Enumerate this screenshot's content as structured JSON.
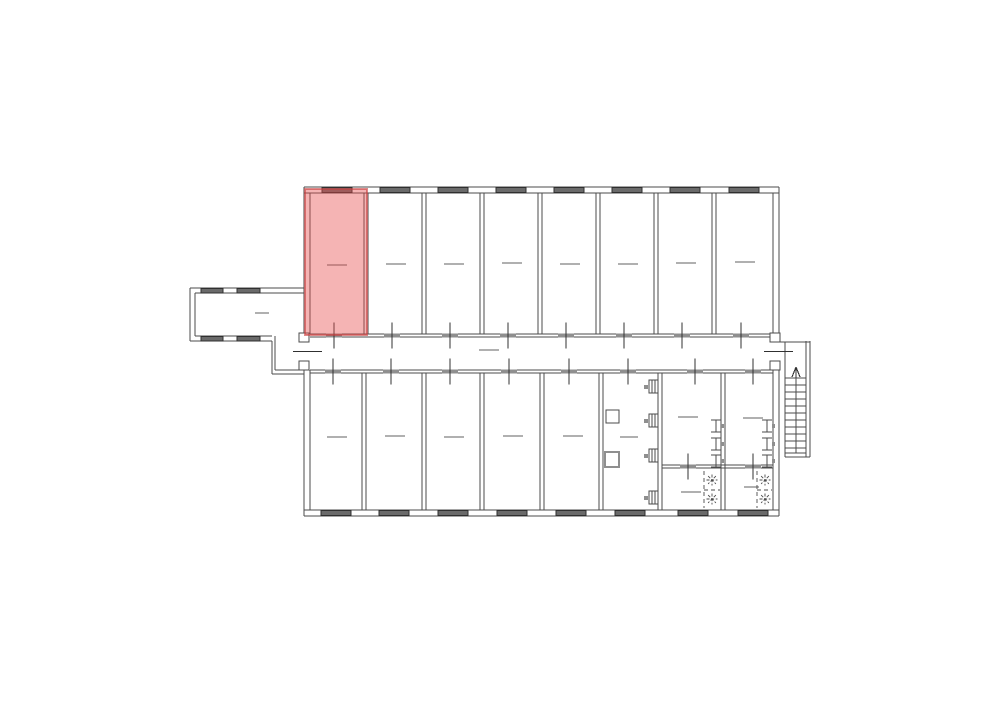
{
  "meta": {
    "type": "architectural-floor-plan",
    "highlighted_room": "top-row room 1 (leftmost)",
    "top_room_count": 8,
    "bottom_room_count": 10
  },
  "colors": {
    "background": "#ffffff",
    "wall": "#4b4b4b",
    "window_fill": "#6a6a6a",
    "window_edge": "#2f2f2f",
    "door_tick": "#8f8f8f",
    "door_line": "#303030",
    "dash": "#606060",
    "fixture": "#4b4b4b",
    "fixture_gray": "#8f8f8f",
    "highlight_fill": "#e74c4c",
    "highlight_fill_opacity": 0.42,
    "highlight_stroke": "#c83c3c",
    "highlight_stroke_opacity": 0.6
  },
  "plan": {
    "canvas": {
      "w": 1000,
      "h": 707
    },
    "highlight": {
      "x": 305,
      "y": 189,
      "w": 62,
      "h": 146
    },
    "walls": [
      [
        304,
        187,
        779,
        187
      ],
      [
        304,
        193,
        779,
        193
      ],
      [
        304,
        516,
        779,
        516
      ],
      [
        304,
        510,
        779,
        510
      ],
      [
        304,
        187,
        304,
        334
      ],
      [
        304,
        370,
        304,
        516
      ],
      [
        310,
        193,
        310,
        334
      ],
      [
        310,
        370,
        310,
        510
      ],
      [
        779,
        187,
        779,
        334
      ],
      [
        779,
        370,
        779,
        516
      ],
      [
        773,
        193,
        773,
        334
      ],
      [
        773,
        370,
        773,
        510
      ],
      [
        310,
        334,
        773,
        334
      ],
      [
        310,
        337,
        773,
        337
      ],
      [
        310,
        370,
        773,
        370
      ],
      [
        310,
        373,
        773,
        373
      ],
      [
        364,
        193,
        364,
        334
      ],
      [
        368,
        193,
        368,
        334
      ],
      [
        422,
        193,
        422,
        334
      ],
      [
        426,
        193,
        426,
        334
      ],
      [
        480,
        193,
        480,
        334
      ],
      [
        484,
        193,
        484,
        334
      ],
      [
        538,
        193,
        538,
        334
      ],
      [
        542,
        193,
        542,
        334
      ],
      [
        596,
        193,
        596,
        334
      ],
      [
        600,
        193,
        600,
        334
      ],
      [
        654,
        193,
        654,
        334
      ],
      [
        658,
        193,
        658,
        334
      ],
      [
        712,
        193,
        712,
        334
      ],
      [
        716,
        193,
        716,
        334
      ],
      [
        362,
        373,
        362,
        510
      ],
      [
        366,
        373,
        366,
        510
      ],
      [
        422,
        373,
        422,
        510
      ],
      [
        426,
        373,
        426,
        510
      ],
      [
        480,
        373,
        480,
        510
      ],
      [
        484,
        373,
        484,
        510
      ],
      [
        540,
        373,
        540,
        510
      ],
      [
        544,
        373,
        544,
        510
      ],
      [
        599,
        373,
        599,
        510
      ],
      [
        603,
        373,
        603,
        510
      ],
      [
        658,
        373,
        658,
        510
      ],
      [
        662,
        373,
        662,
        510
      ],
      [
        721,
        373,
        721,
        510
      ],
      [
        725,
        373,
        725,
        510
      ],
      [
        662,
        465,
        773,
        465
      ],
      [
        662,
        468,
        773,
        468
      ],
      [
        190,
        288,
        304,
        288
      ],
      [
        195,
        293,
        304,
        293
      ],
      [
        190,
        288,
        190,
        341
      ],
      [
        195,
        293,
        195,
        336
      ],
      [
        190,
        341,
        272,
        341
      ],
      [
        195,
        336,
        272,
        336
      ],
      [
        272,
        341,
        272,
        374
      ],
      [
        275,
        336,
        275,
        370
      ],
      [
        272,
        374,
        304,
        374
      ],
      [
        275,
        370,
        304,
        370
      ],
      [
        779,
        342,
        810,
        342
      ],
      [
        785,
        342,
        785,
        457
      ],
      [
        806,
        341,
        806,
        457
      ],
      [
        810,
        341,
        810,
        457
      ],
      [
        785,
        453,
        806,
        453
      ],
      [
        785,
        457,
        810,
        457
      ]
    ],
    "windows": [
      [
        322,
        187.5,
        30,
        5
      ],
      [
        380,
        187.5,
        30,
        5
      ],
      [
        438,
        187.5,
        30,
        5
      ],
      [
        496,
        187.5,
        30,
        5
      ],
      [
        554,
        187.5,
        30,
        5
      ],
      [
        612,
        187.5,
        30,
        5
      ],
      [
        670,
        187.5,
        30,
        5
      ],
      [
        729,
        187.5,
        30,
        5
      ],
      [
        321,
        510.5,
        30,
        5
      ],
      [
        379,
        510.5,
        30,
        5
      ],
      [
        438,
        510.5,
        30,
        5
      ],
      [
        497,
        510.5,
        30,
        5
      ],
      [
        556,
        510.5,
        30,
        5
      ],
      [
        615,
        510.5,
        30,
        5
      ],
      [
        678,
        510.5,
        30,
        5
      ],
      [
        738,
        510.5,
        30,
        5
      ],
      [
        201,
        288.5,
        22,
        4.5
      ],
      [
        237,
        288.5,
        23,
        4.5
      ],
      [
        201,
        336.5,
        22,
        4.5
      ],
      [
        237,
        336.5,
        23,
        4.5
      ]
    ],
    "doors": [
      [
        334,
        335.5
      ],
      [
        392,
        335.5
      ],
      [
        450,
        335.5
      ],
      [
        508,
        335.5
      ],
      [
        566,
        335.5
      ],
      [
        624,
        335.5
      ],
      [
        682,
        335.5
      ],
      [
        741,
        335.5
      ],
      [
        333,
        371.5
      ],
      [
        391,
        371.5
      ],
      [
        450,
        371.5
      ],
      [
        509,
        371.5
      ],
      [
        569,
        371.5
      ],
      [
        628,
        371.5
      ],
      [
        695,
        371.5
      ],
      [
        753,
        371.5
      ],
      [
        688,
        466.5
      ],
      [
        753,
        466.5
      ]
    ],
    "passages": [
      {
        "jambs": [
          [
            299,
            333,
            10,
            9
          ],
          [
            299,
            361,
            10,
            9
          ]
        ],
        "line": [
          293,
          351.5,
          322,
          351.5
        ]
      },
      {
        "jambs": [
          [
            770,
            333,
            10,
            9
          ],
          [
            770,
            361,
            10,
            9
          ]
        ],
        "line": [
          764,
          351.5,
          793,
          351.5
        ]
      }
    ],
    "dashes": [
      [
        327,
        347,
        265
      ],
      [
        386,
        406,
        264
      ],
      [
        444,
        464,
        264
      ],
      [
        502,
        522,
        263
      ],
      [
        560,
        580,
        264
      ],
      [
        618,
        638,
        264
      ],
      [
        676,
        696,
        263
      ],
      [
        735,
        755,
        262
      ],
      [
        255,
        269,
        313
      ],
      [
        479,
        499,
        350
      ],
      [
        327,
        347,
        437
      ],
      [
        385,
        405,
        436
      ],
      [
        444,
        464,
        437
      ],
      [
        503,
        523,
        436
      ],
      [
        563,
        583,
        436
      ],
      [
        620,
        638,
        437
      ],
      [
        678,
        698,
        417
      ],
      [
        743,
        763,
        418
      ],
      [
        681,
        701,
        492
      ],
      [
        744,
        759,
        487
      ]
    ],
    "toilets": [
      [
        711,
        420
      ],
      [
        711,
        438
      ],
      [
        711,
        455
      ],
      [
        762,
        420
      ],
      [
        762,
        438
      ],
      [
        762,
        455
      ]
    ],
    "basins": [
      [
        649,
        380
      ],
      [
        649,
        414
      ],
      [
        649,
        449
      ],
      [
        649,
        491
      ]
    ],
    "squares": [
      [
        606,
        410,
        13,
        13,
        1,
        "fixture"
      ],
      [
        605,
        452,
        14,
        15,
        1.8,
        "fixture_gray"
      ]
    ],
    "shower_dashed": [
      [
        704,
        471,
        704,
        508
      ],
      [
        704,
        490,
        720,
        490
      ],
      [
        757,
        471,
        757,
        508
      ],
      [
        757,
        490,
        772,
        490
      ]
    ],
    "shower_stars": [
      [
        712,
        480
      ],
      [
        712,
        499
      ],
      [
        765,
        480
      ],
      [
        765,
        499
      ]
    ],
    "stairs": {
      "tread_x": [
        785,
        806
      ],
      "tread_ys": [
        378,
        385,
        392,
        399,
        406,
        413,
        420,
        427,
        434,
        441,
        448
      ],
      "center_line": [
        796,
        368,
        796,
        453
      ],
      "arrow": [
        [
          796,
          378,
          796,
          367
        ],
        [
          792,
          377,
          796,
          367
        ],
        [
          800,
          377,
          796,
          367
        ]
      ]
    }
  }
}
